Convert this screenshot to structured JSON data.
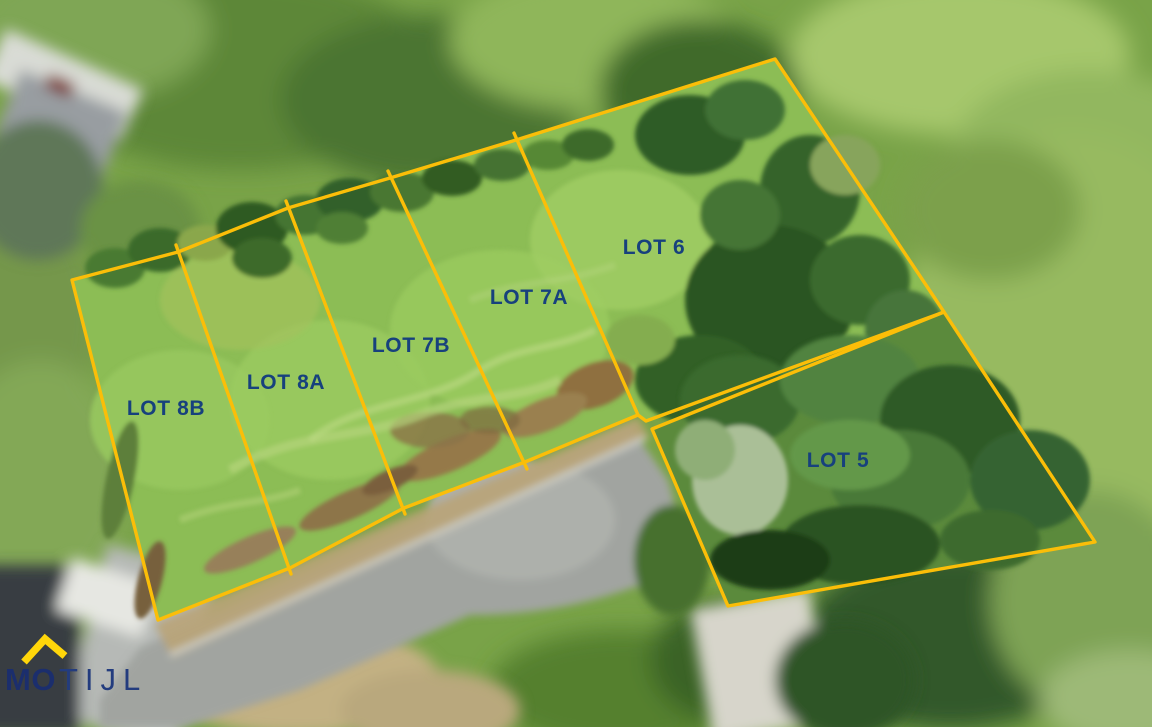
{
  "map": {
    "description": "Aerial drone photo with land-parcel boundary overlay",
    "overlay": {
      "boundary_color": "#FBBE08",
      "label_color": "#17417D",
      "lots": [
        {
          "id": "8B",
          "label": "LOT 8B"
        },
        {
          "id": "8A",
          "label": "LOT 8A"
        },
        {
          "id": "7B",
          "label": "LOT 7B"
        },
        {
          "id": "7A",
          "label": "LOT 7A"
        },
        {
          "id": "6",
          "label": "LOT 6"
        },
        {
          "id": "5",
          "label": "LOT 5"
        }
      ]
    }
  },
  "logo": {
    "text_bold": "MO",
    "text_light": "TIJL",
    "roof_color": "#FFD60A",
    "text_color": "#1B2E6D"
  }
}
